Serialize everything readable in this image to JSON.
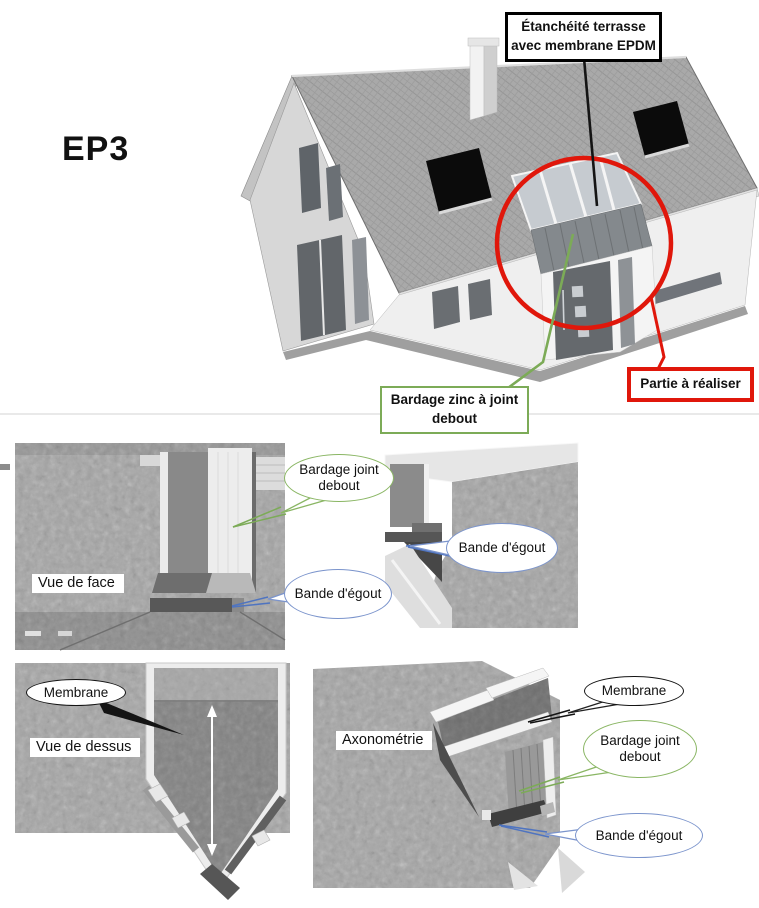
{
  "heading": {
    "code": "EP3"
  },
  "annotations": {
    "epdm": "Étanchéité terrasse avec membrane EPDM",
    "zinc": "Bardage zinc à joint debout",
    "partie": "Partie à réaliser"
  },
  "views": {
    "front": {
      "label": "Vue de face"
    },
    "top": {
      "label": "Vue de dessus"
    },
    "axo": {
      "label": "Axonométrie"
    }
  },
  "callouts": {
    "front_bardage": "Bardage joint debout",
    "front_bande": "Bande d'égout",
    "side_bande": "Bande d'égout",
    "top_membrane": "Membrane",
    "axo_membrane": "Membrane",
    "axo_bardage": "Bardage joint debout",
    "axo_bande": "Bande d'égout"
  },
  "colors": {
    "highlight_red": "#e0170b",
    "callout_green": "#7cab57",
    "callout_green_light": "#8ab664",
    "callout_blue": "#7b94cc",
    "leader_blue": "#4f74c0",
    "box_black": "#000000"
  }
}
